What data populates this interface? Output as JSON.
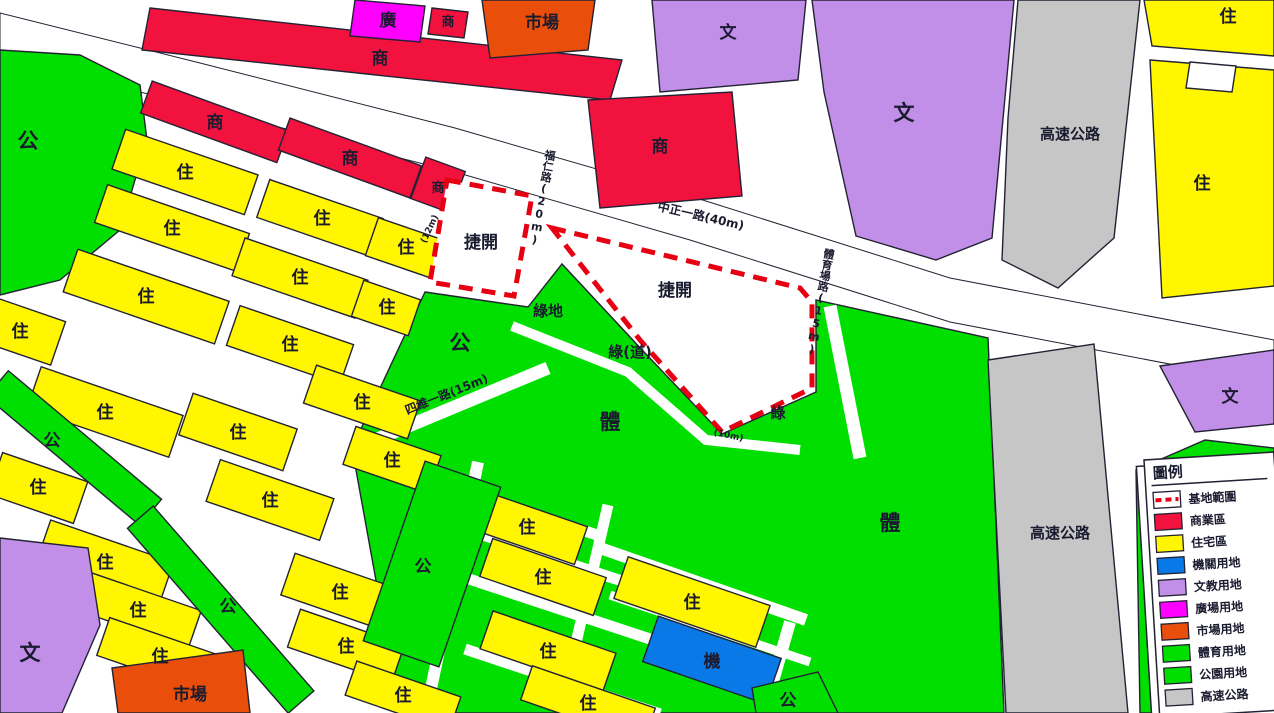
{
  "map": {
    "zone_labels": {
      "residential": "住",
      "commercial": "商",
      "park": "公",
      "sports": "體",
      "culture": "文",
      "market": "市場",
      "plaza": "廣",
      "institution": "機",
      "green": "綠",
      "green_land": "綠地",
      "green_way": "綠(道)",
      "highway": "高速公路",
      "site": "捷開"
    },
    "roads": {
      "zhongzheng": "中正一路(40m)",
      "furen": "福仁路(20m)",
      "siwei": "四維一路(15m)",
      "stadium": "體育場路(15m)",
      "w10": "(10m)",
      "w12": "(12m)"
    }
  },
  "legend": {
    "title": "圖例",
    "items": [
      {
        "label": "基地範圍",
        "type": "dash",
        "color": "#E60012"
      },
      {
        "label": "商業區",
        "type": "fill",
        "color": "#F2123E"
      },
      {
        "label": "住宅區",
        "type": "fill",
        "color": "#FFF600"
      },
      {
        "label": "機關用地",
        "type": "fill",
        "color": "#0A79E8"
      },
      {
        "label": "文教用地",
        "type": "fill",
        "color": "#C28FE8"
      },
      {
        "label": "廣場用地",
        "type": "fill",
        "color": "#FF00FF"
      },
      {
        "label": "市場用地",
        "type": "fill",
        "color": "#E94E0A"
      },
      {
        "label": "體育用地",
        "type": "fill",
        "color": "#00DF00"
      },
      {
        "label": "公園用地",
        "type": "fill",
        "color": "#00DF00"
      },
      {
        "label": "高速公路",
        "type": "fill",
        "color": "#C6C6C6"
      }
    ]
  },
  "colors": {
    "commercial": "#F2123E",
    "residential": "#FFF600",
    "institution": "#0A79E8",
    "culture": "#C28FE8",
    "plaza": "#FF00FF",
    "market": "#E94E0A",
    "sports_park": "#00DF00",
    "highway": "#C6C6C6",
    "site_boundary": "#E60012",
    "road": "#FFFFFF",
    "outline": "#222233",
    "label_text": "#1B1B30"
  }
}
